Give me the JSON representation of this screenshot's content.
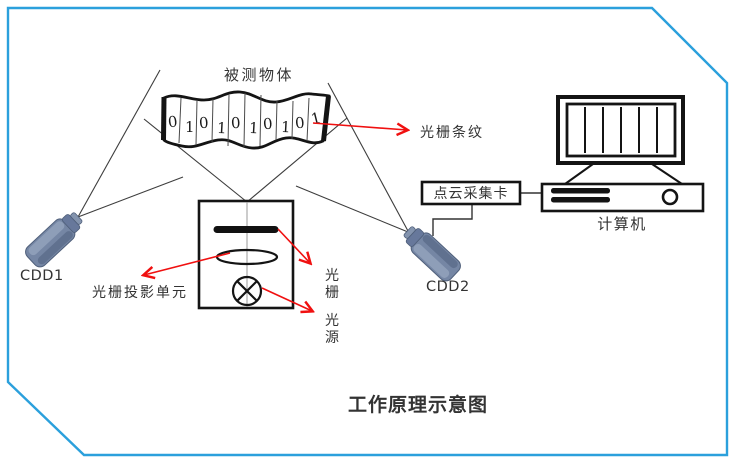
{
  "colors": {
    "frame_blue": "#2BA0DC",
    "annotation_red": "#F01010",
    "title_red": "#F00000",
    "line_gray": "#3D3D3D",
    "ink_black": "#141414",
    "camera_body": "#7586A4",
    "camera_shade": "#5B6B89",
    "text": "#333333"
  },
  "labels": {
    "measured_object": "被测物体",
    "grating_stripes": "光栅条纹",
    "point_cloud_card": "点云采集卡",
    "computer": "计算机",
    "camera1": "CDD1",
    "camera2": "CDD2",
    "projection_unit": "光栅投影单元",
    "grating_vertical": [
      "光",
      "栅"
    ],
    "light_source_vertical": [
      "光",
      "源"
    ],
    "title": "工作原理示意图"
  },
  "object_pattern": {
    "digits": [
      "0",
      "1",
      "0",
      "1",
      "0",
      "1",
      "0",
      "1",
      "0",
      "1"
    ]
  },
  "icons": {
    "camera": "ccd-camera-icon",
    "monitor": "computer-monitor-icon",
    "system_unit": "computer-case-icon",
    "lamp": "light-source-lamp-icon",
    "lens": "lens-icon",
    "grating_slide": "grating-bar-icon"
  }
}
